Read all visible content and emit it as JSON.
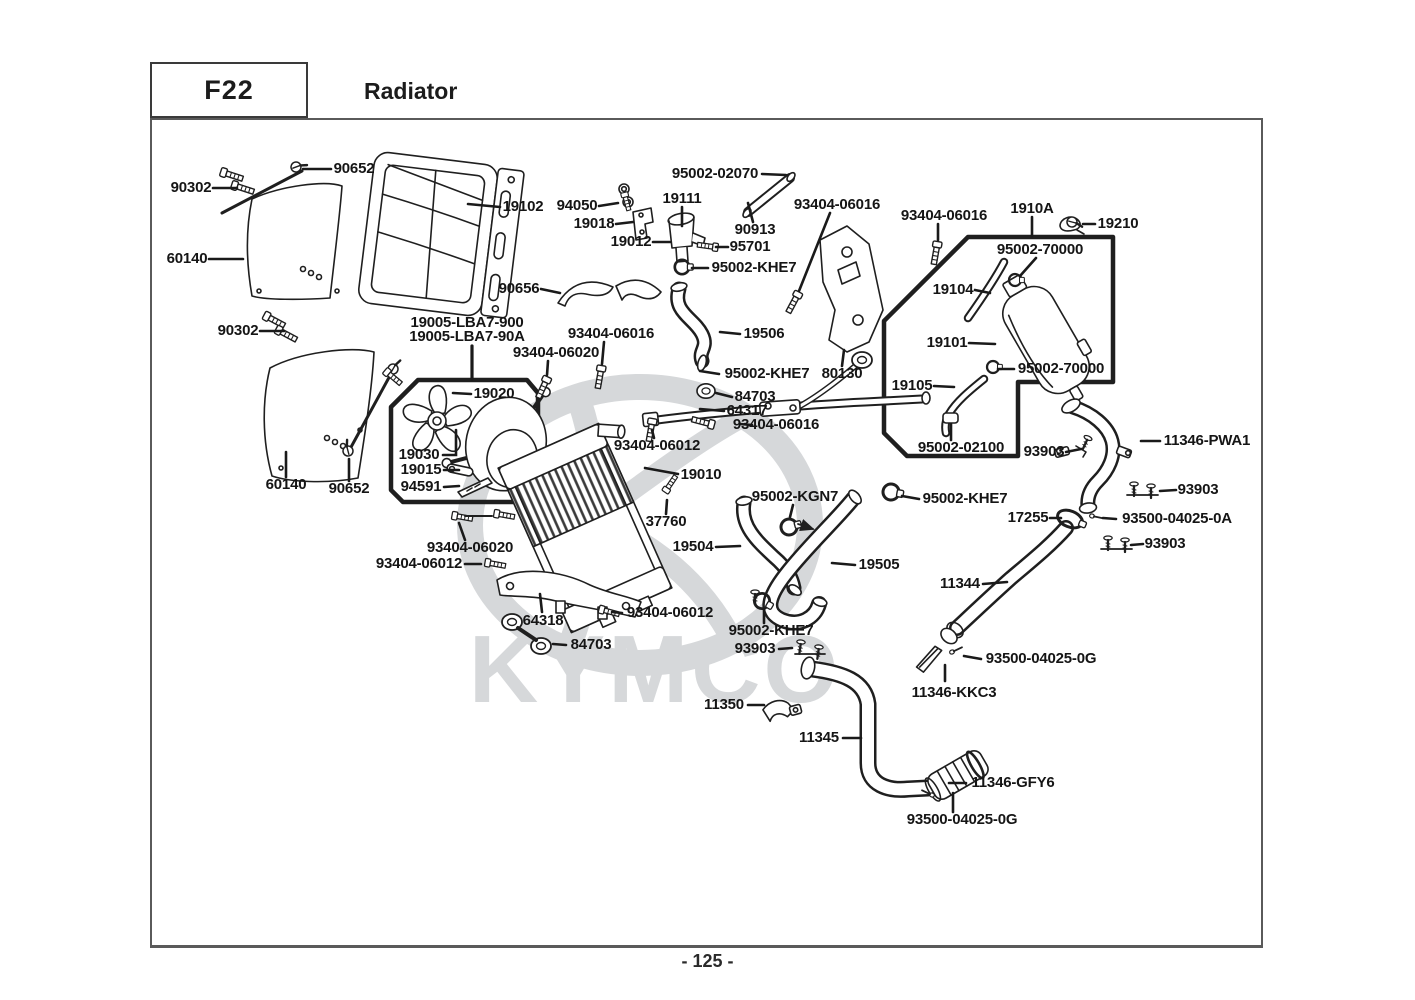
{
  "header": {
    "code": "F22",
    "title": "Radiator"
  },
  "footer": {
    "page": "- 125 -"
  },
  "watermark": {
    "text": "KYMCO",
    "color": "#d6d8da"
  },
  "labels": [
    {
      "text": "90652",
      "x": 354,
      "y": 169
    },
    {
      "text": "90302",
      "x": 191,
      "y": 188
    },
    {
      "text": "60140",
      "x": 187,
      "y": 259
    },
    {
      "text": "90302",
      "x": 238,
      "y": 331
    },
    {
      "text": "60140",
      "x": 286,
      "y": 485
    },
    {
      "text": "90652",
      "x": 349,
      "y": 489
    },
    {
      "text": "19102",
      "x": 523,
      "y": 207
    },
    {
      "text": "94050",
      "x": 577,
      "y": 206
    },
    {
      "text": "19018",
      "x": 594,
      "y": 224
    },
    {
      "text": "19012",
      "x": 631,
      "y": 242
    },
    {
      "text": "19111",
      "x": 682,
      "y": 199
    },
    {
      "text": "95002-02070",
      "x": 715,
      "y": 174
    },
    {
      "text": "90913",
      "x": 755,
      "y": 230
    },
    {
      "text": "95701",
      "x": 750,
      "y": 247
    },
    {
      "text": "95002-KHE7",
      "x": 754,
      "y": 268
    },
    {
      "text": "90656",
      "x": 519,
      "y": 289
    },
    {
      "text": "93404-06016",
      "x": 837,
      "y": 205
    },
    {
      "text": "93404-06016",
      "x": 944,
      "y": 216
    },
    {
      "text": "1910A",
      "x": 1032,
      "y": 209
    },
    {
      "text": "19210",
      "x": 1118,
      "y": 224
    },
    {
      "text": "95002-70000",
      "x": 1040,
      "y": 250
    },
    {
      "text": "19104",
      "x": 953,
      "y": 290
    },
    {
      "text": "19101",
      "x": 947,
      "y": 343
    },
    {
      "text": "19105",
      "x": 912,
      "y": 386
    },
    {
      "text": "95002-70000",
      "x": 1061,
      "y": 369
    },
    {
      "text": "95002-02100",
      "x": 961,
      "y": 448
    },
    {
      "text": "93903",
      "x": 1044,
      "y": 452
    },
    {
      "text": "11346-PWA1",
      "x": 1207,
      "y": 441
    },
    {
      "text": "93903",
      "x": 1198,
      "y": 490
    },
    {
      "text": "17255",
      "x": 1028,
      "y": 518
    },
    {
      "text": "93500-04025-0A",
      "x": 1177,
      "y": 519
    },
    {
      "text": "93903",
      "x": 1165,
      "y": 544
    },
    {
      "text": "19005-LBA7-900",
      "x": 467,
      "y": 323
    },
    {
      "text": "19005-LBA7-90A",
      "x": 467,
      "y": 337
    },
    {
      "text": "93404-06016",
      "x": 611,
      "y": 334
    },
    {
      "text": "93404-06020",
      "x": 556,
      "y": 353
    },
    {
      "text": "19506",
      "x": 764,
      "y": 334
    },
    {
      "text": "95002-KHE7",
      "x": 767,
      "y": 374
    },
    {
      "text": "80130",
      "x": 842,
      "y": 374
    },
    {
      "text": "84703",
      "x": 755,
      "y": 397
    },
    {
      "text": "64317",
      "x": 747,
      "y": 411
    },
    {
      "text": "93404-06016",
      "x": 776,
      "y": 425
    },
    {
      "text": "93404-06012",
      "x": 657,
      "y": 446
    },
    {
      "text": "19020",
      "x": 494,
      "y": 394
    },
    {
      "text": "19030",
      "x": 419,
      "y": 455
    },
    {
      "text": "19015",
      "x": 421,
      "y": 470
    },
    {
      "text": "94591",
      "x": 421,
      "y": 487
    },
    {
      "text": "19010",
      "x": 701,
      "y": 475
    },
    {
      "text": "37760",
      "x": 666,
      "y": 522
    },
    {
      "text": "95002-KGN7",
      "x": 795,
      "y": 497
    },
    {
      "text": "95002-KHE7",
      "x": 965,
      "y": 499
    },
    {
      "text": "19504",
      "x": 693,
      "y": 547
    },
    {
      "text": "19505",
      "x": 879,
      "y": 565
    },
    {
      "text": "11344",
      "x": 960,
      "y": 584
    },
    {
      "text": "93404-06020",
      "x": 470,
      "y": 548
    },
    {
      "text": "93404-06012",
      "x": 419,
      "y": 564
    },
    {
      "text": "93404-06012",
      "x": 670,
      "y": 613
    },
    {
      "text": "64318",
      "x": 543,
      "y": 621
    },
    {
      "text": "84703",
      "x": 591,
      "y": 645
    },
    {
      "text": "95002-KHE7",
      "x": 771,
      "y": 631
    },
    {
      "text": "93903",
      "x": 755,
      "y": 649
    },
    {
      "text": "11350",
      "x": 724,
      "y": 705
    },
    {
      "text": "11345",
      "x": 819,
      "y": 738
    },
    {
      "text": "93500-04025-0G",
      "x": 1041,
      "y": 659
    },
    {
      "text": "11346-KKC3",
      "x": 954,
      "y": 693
    },
    {
      "text": "11346-GFY6",
      "x": 1013,
      "y": 783
    },
    {
      "text": "93500-04025-0G",
      "x": 962,
      "y": 820
    }
  ]
}
